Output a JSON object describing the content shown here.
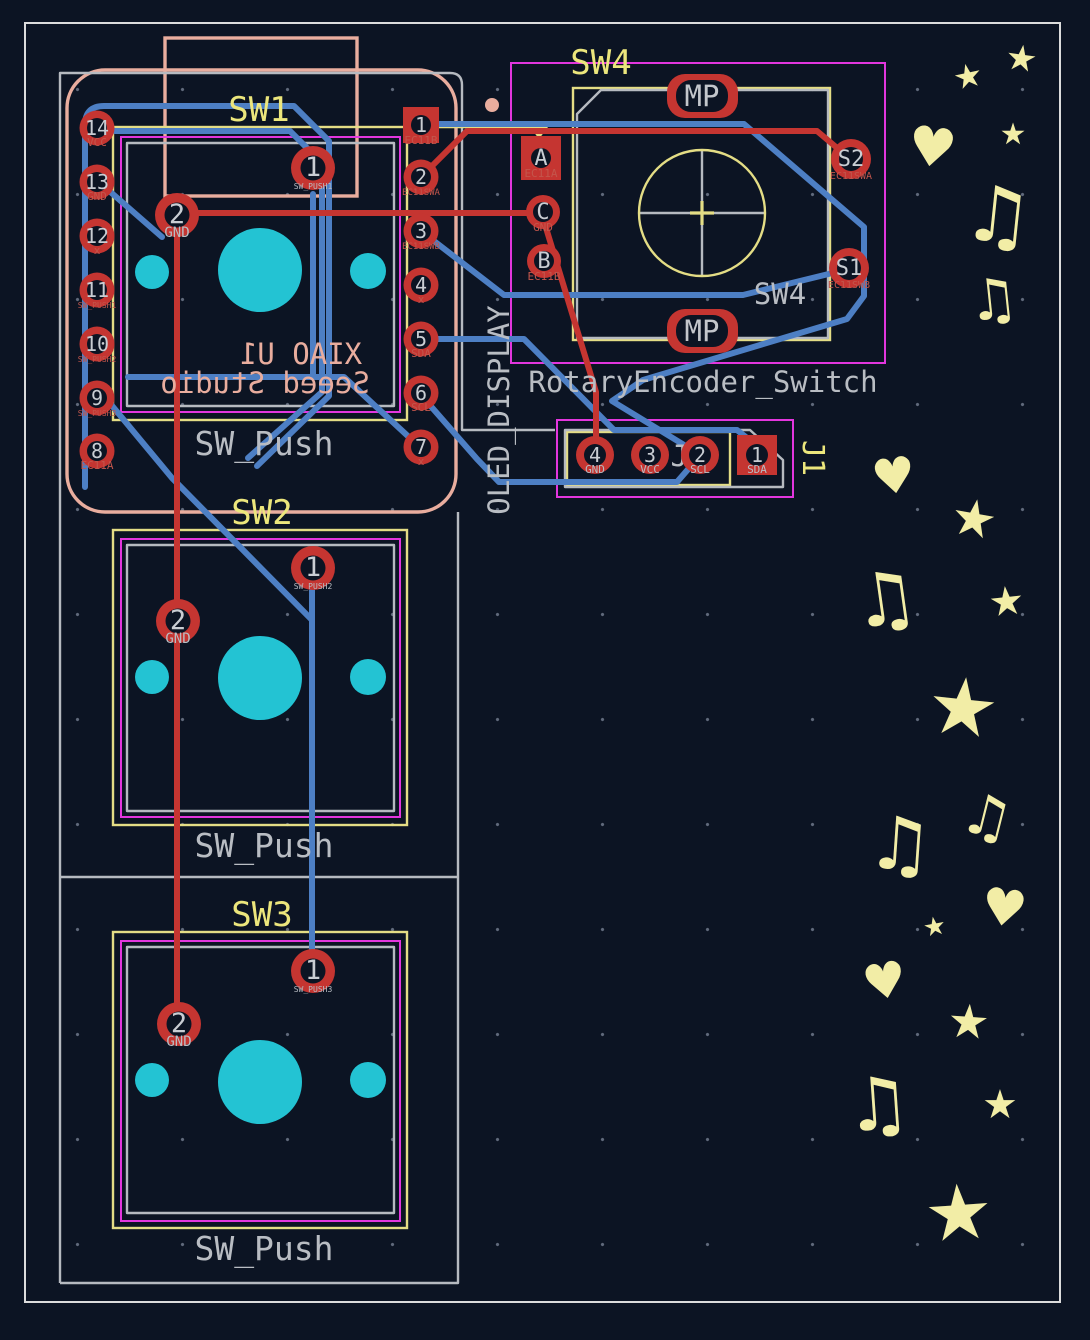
{
  "labels": {
    "sw1": "SW1",
    "sw2": "SW2",
    "sw3": "SW3",
    "sw4_ref": "SW4",
    "sw4_value": "SW4",
    "sw_push": "SW_Push",
    "rotary": "RotaryEncoder_Switch",
    "oled": "OLED_DISPLAY",
    "j1_ref": "J1",
    "j1_value": "J1",
    "xiao_line1": "XIAO U1",
    "xiao_line2": "Seeed Studio"
  },
  "pads": {
    "xiao_left": [
      {
        "num": "14",
        "net": "VCC"
      },
      {
        "num": "13",
        "net": "GND"
      },
      {
        "num": "12",
        "net": "x"
      },
      {
        "num": "11",
        "net": "SW_PUSH1"
      },
      {
        "num": "10",
        "net": "SW_PUSH2"
      },
      {
        "num": "9",
        "net": "SW_PUSH3"
      },
      {
        "num": "8",
        "net": "EC11A"
      }
    ],
    "xiao_right": [
      {
        "num": "1",
        "net": "EC11B"
      },
      {
        "num": "2",
        "net": "EC11SWA"
      },
      {
        "num": "3",
        "net": "EC11SWB"
      },
      {
        "num": "4",
        "net": "x"
      },
      {
        "num": "5",
        "net": "SDA"
      },
      {
        "num": "6",
        "net": "SCL"
      },
      {
        "num": "7",
        "net": "x"
      }
    ],
    "sw1": {
      "p1num": "1",
      "p1net": "SW_PUSH1",
      "p2num": "2",
      "p2net": "GND"
    },
    "sw2": {
      "p1num": "1",
      "p1net": "SW_PUSH2",
      "p2num": "2",
      "p2net": "GND"
    },
    "sw3": {
      "p1num": "1",
      "p1net": "SW_PUSH3",
      "p2num": "2",
      "p2net": "GND"
    },
    "sw4": {
      "a": "A",
      "a_net": "EC11A",
      "c": "C",
      "c_net": "GND",
      "b": "B",
      "b_net": "EC11B",
      "s2": "S2",
      "s2_net": "EC11SWA",
      "s1": "S1",
      "s1_net": "EC11SWB",
      "mp": "MP"
    },
    "j1": [
      {
        "num": "4",
        "net": "GND"
      },
      {
        "num": "3",
        "net": "VCC"
      },
      {
        "num": "2",
        "net": "SCL"
      },
      {
        "num": "1",
        "net": "SDA"
      }
    ]
  },
  "glyphs": {
    "star": "★",
    "heart": "♥",
    "music": "♫"
  },
  "colors": {
    "background": "#0c1423",
    "front_copper": "#c53531",
    "back_copper": "#4d7fc4",
    "holes": "#23c3d3",
    "fab": "#e4dd85",
    "courtyard": "#e336de",
    "silkscreen_front": "#b9bdc3",
    "silkscreen_back": "#e9ad9e",
    "silkscreen_art": "#f2eda6",
    "board_edge": "#dcdcdc"
  }
}
